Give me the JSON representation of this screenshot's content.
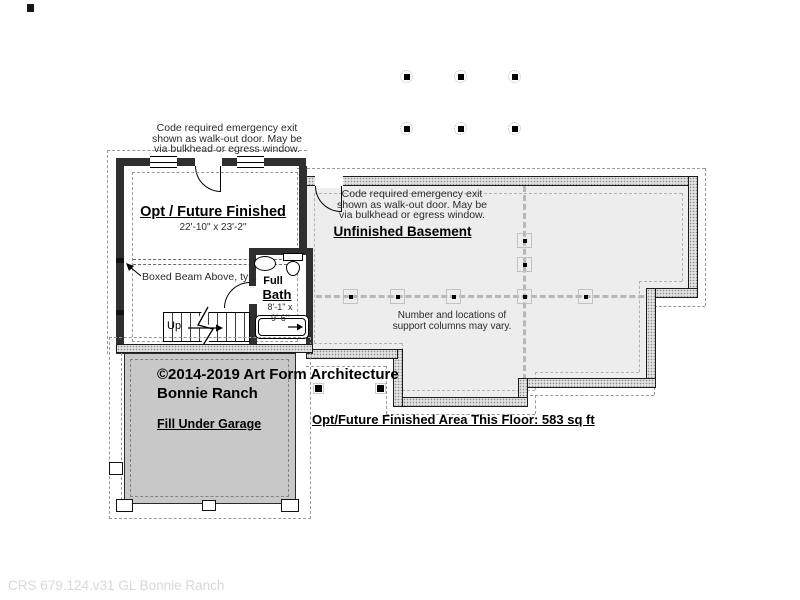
{
  "colors": {
    "wall_framed": "#2f2f2f",
    "wall_foundation_fill": "#e4e4e4",
    "basement_floor": "#ededed",
    "garage_fill": "#c8c8c8",
    "beam_dash": "#b7b7b7",
    "footer_text": "#d9d9d9"
  },
  "notes": {
    "exit_left": {
      "l1": "Code required emergency exit",
      "l2": "shown as walk-out door. May be",
      "l3": "via bulkhead or egress window."
    },
    "exit_right": {
      "l1": "Code required emergency exit",
      "l2": "shown as walk-out door. May be",
      "l3": "via bulkhead or egress window."
    },
    "boxed_beam": "Boxed Beam Above, typ.",
    "columns": {
      "l1": "Number and locations of",
      "l2": "support columns may vary."
    },
    "area": "Opt/Future Finished Area This Floor: 583 sq ft"
  },
  "rooms": {
    "opt": {
      "label": "Opt / Future Finished",
      "dims": "22'-10\" x 23'-2\""
    },
    "basement": {
      "label": "Unfinished Basement"
    },
    "bath": {
      "l1": "Full",
      "l2": "Bath",
      "d1": "8'-1\" x",
      "d2": "9'-6\""
    },
    "garage": {
      "label": "Fill Under Garage"
    },
    "stairs": {
      "label": "Up"
    }
  },
  "titleblock": {
    "line1": "©2014-2019 Art Form Architecture",
    "line2": "Bonnie Ranch"
  },
  "footer": {
    "label": "CRS 679.124.v31 GL Bonnie Ranch"
  }
}
